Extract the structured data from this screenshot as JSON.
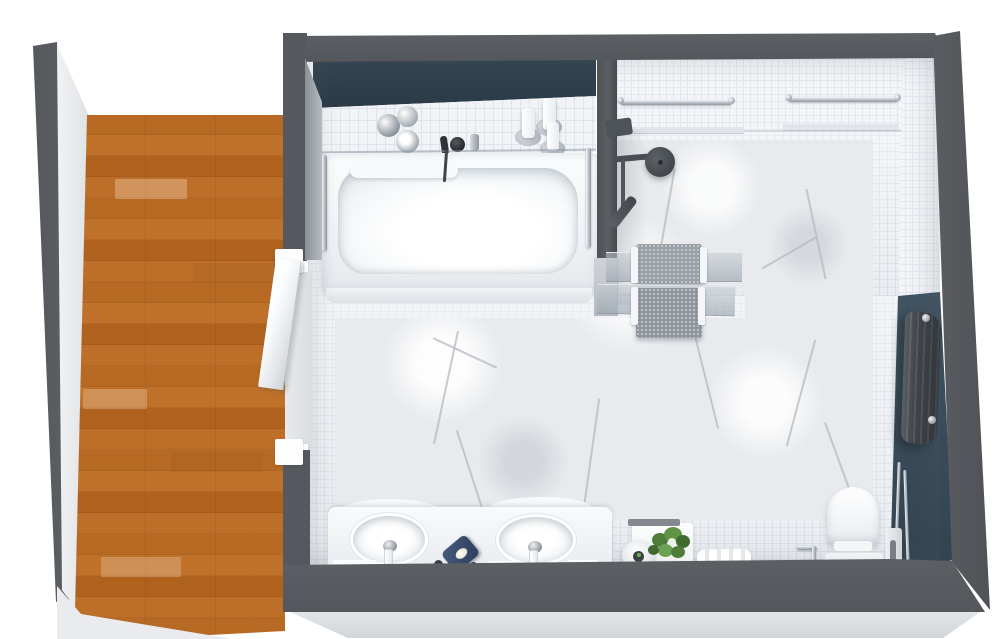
{
  "scene": {
    "type": "3d-floorplan-top-view",
    "title": "Bathroom floor plan with hallway",
    "palette": {
      "wall_dark": "#55585c",
      "accent_blue_tub": "#33434f",
      "accent_blue_right": "#3e5160",
      "wood_floor": "#d7a25c",
      "tile_floor": "#eef1f5",
      "marble": "#e8eaed",
      "ceramic_white": "#ffffff",
      "chrome": "#c3c9d0",
      "fixture_dark": "#4a4f54",
      "soap_dish_navy": "#37486b",
      "plant_green": "#5f9447"
    },
    "areas": {
      "hallway": {
        "label": "Hallway with wood plank flooring"
      },
      "bathroom": {
        "label": "Bathroom with white mosaic tile and marble slab flooring"
      },
      "shower": {
        "label": "Walk-in shower with marble floor"
      }
    },
    "fixtures": {
      "bathtub": {
        "label": "Bathtub with glass screen"
      },
      "tub_faucet": {
        "label": "Black wall-mounted tub faucet"
      },
      "canisters": {
        "label": "Chrome toiletry canisters"
      },
      "candles": {
        "label": "White candles on tub ledge"
      },
      "grab_bars": {
        "label": "Chrome grab bars"
      },
      "shower_head": {
        "label": "Round rain shower head"
      },
      "hand_shower": {
        "label": "Hand shower on rail"
      },
      "glass_partition": {
        "label": "Glass shower partition"
      },
      "towels": {
        "label": "Gray towels on towel bars"
      },
      "vanity": {
        "label": "Double-sink vanity counter"
      },
      "sink_left": {
        "label": "Left oval washbasin"
      },
      "sink_right": {
        "label": "Right oval washbasin"
      },
      "soap_dish": {
        "label": "Navy soap dish with soap"
      },
      "cabinet": {
        "label": "Low side cabinet"
      },
      "bowl": {
        "label": "Round decorative bowl"
      },
      "plant": {
        "label": "Potted green plant"
      },
      "towel_stack": {
        "label": "Folded towel on holder"
      },
      "toilet": {
        "label": "Toilet"
      },
      "toilet_brush": {
        "label": "Toilet brush set"
      },
      "radiator": {
        "label": "Dark wall radiator"
      },
      "door": {
        "label": "White door, ajar"
      },
      "accent_wall": {
        "label": "Dark blue accent wall"
      }
    }
  }
}
